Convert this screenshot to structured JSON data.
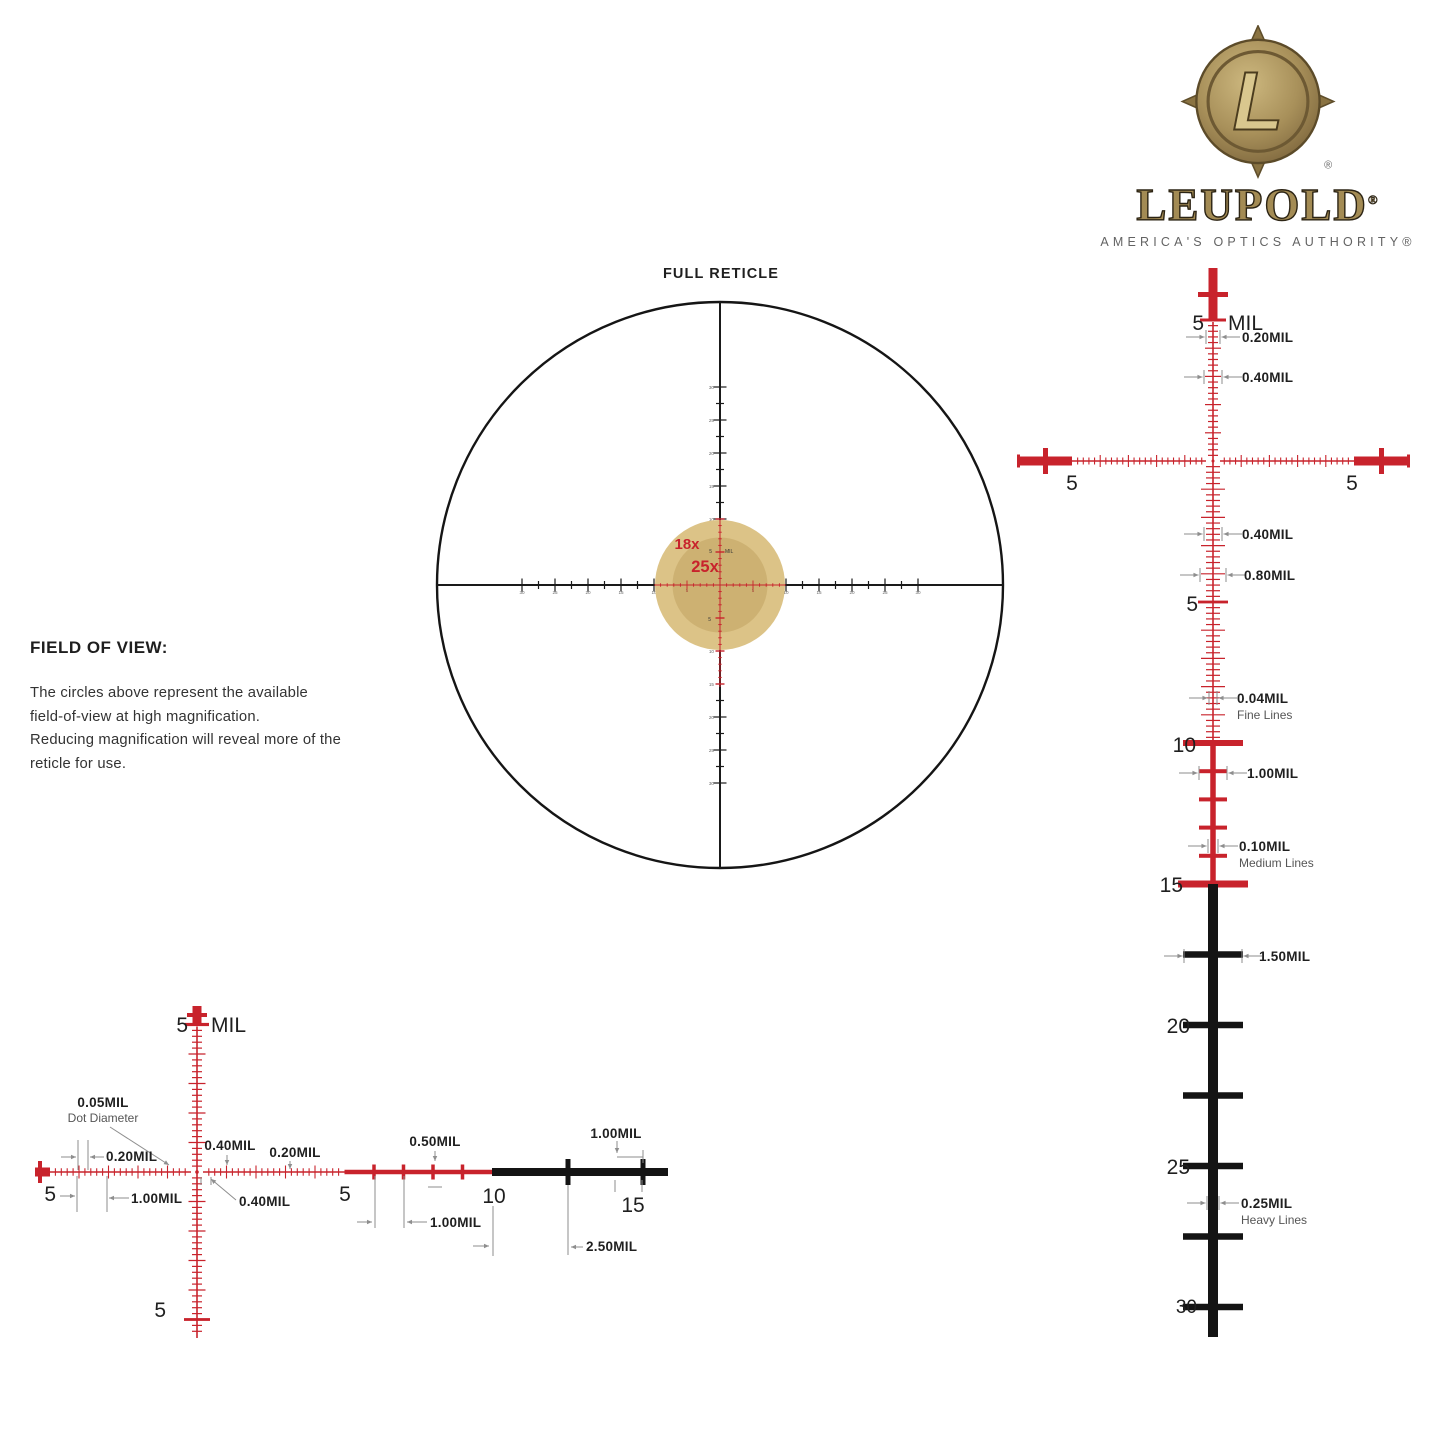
{
  "colors": {
    "red": "#c8232c",
    "black": "#141414",
    "gray": "#8e8e8e",
    "text": "#1f1f1f",
    "sub": "#555555",
    "fov_outer": "#dcc387",
    "fov_inner": "#cdb172"
  },
  "logo": {
    "monogram": "L",
    "registered": "®",
    "wordmark": "LEUPOLD",
    "tagline": "AMERICA'S OPTICS AUTHORITY®"
  },
  "fov": {
    "heading": "FIELD OF VIEW:",
    "lines": [
      "The circles above represent the available",
      "field-of-view at high magnification.",
      "Reducing magnification will reveal more of the",
      "reticle for use."
    ]
  },
  "full_reticle": {
    "title": "FULL RETICLE",
    "axis_labels": [
      "10",
      "15",
      "20",
      "25",
      "30"
    ],
    "labels": [
      {
        "t": "FULL RETICLE",
        "x": 721,
        "y": 278,
        "s": 14.5,
        "cls": "title",
        "n": "full-reticle-title"
      },
      {
        "t": "18x",
        "x": 687,
        "y": 549,
        "s": 15,
        "c": "#c8232c",
        "cls": "mag",
        "n": "magnification-18x-label"
      },
      {
        "t": "25x",
        "x": 705,
        "y": 572,
        "s": 16.5,
        "c": "#c8232c",
        "cls": "mag",
        "n": "magnification-25x-label"
      },
      {
        "t": "5",
        "x": 712,
        "y": 553,
        "s": 5,
        "a": "end",
        "c": "#333333",
        "n": "mil-number"
      },
      {
        "t": "MIL",
        "x": 725,
        "y": 553,
        "s": 5,
        "a": "start",
        "c": "#333333",
        "n": "mil-unit"
      },
      {
        "t": "5",
        "x": 711,
        "y": 621,
        "s": 5,
        "a": "end",
        "c": "#333333",
        "n": "mil-number"
      }
    ]
  },
  "vertical_detail": {
    "labels": [
      {
        "t": "5",
        "x": 1204,
        "y": 330,
        "s": 21,
        "a": "end",
        "cls": "num",
        "n": "mil-number"
      },
      {
        "t": "MIL",
        "x": 1228,
        "y": 330,
        "s": 21,
        "a": "start",
        "cls": "num",
        "n": "mil-unit"
      },
      {
        "t": "0.20MIL",
        "x": 1242,
        "y": 342,
        "s": 13.5,
        "a": "start",
        "cls": "dim",
        "n": "dim-label"
      },
      {
        "t": "0.40MIL",
        "x": 1242,
        "y": 382,
        "s": 13.5,
        "a": "start",
        "cls": "dim",
        "n": "dim-label"
      },
      {
        "t": "0.40MIL",
        "x": 1242,
        "y": 539,
        "s": 13.5,
        "a": "start",
        "cls": "dim",
        "n": "dim-label"
      },
      {
        "t": "0.80MIL",
        "x": 1244,
        "y": 580,
        "s": 13.5,
        "a": "start",
        "cls": "dim",
        "n": "dim-label"
      },
      {
        "t": "5",
        "x": 1198,
        "y": 611,
        "s": 21,
        "a": "end",
        "cls": "num",
        "n": "mil-number"
      },
      {
        "t": "0.04MIL",
        "x": 1237,
        "y": 703,
        "s": 13.5,
        "a": "start",
        "cls": "dim",
        "n": "dim-label"
      },
      {
        "t": "Fine Lines",
        "x": 1237,
        "y": 719,
        "s": 12,
        "a": "start",
        "cls": "sub",
        "n": "line-weight-label"
      },
      {
        "t": "10",
        "x": 1196,
        "y": 752,
        "s": 21,
        "a": "end",
        "cls": "num",
        "n": "mil-number"
      },
      {
        "t": "1.00MIL",
        "x": 1247,
        "y": 778,
        "s": 13.5,
        "a": "start",
        "cls": "dim",
        "n": "dim-label"
      },
      {
        "t": "0.10MIL",
        "x": 1239,
        "y": 851,
        "s": 13.5,
        "a": "start",
        "cls": "dim",
        "n": "dim-label"
      },
      {
        "t": "Medium Lines",
        "x": 1239,
        "y": 867,
        "s": 12,
        "a": "start",
        "cls": "sub",
        "n": "line-weight-label"
      },
      {
        "t": "15",
        "x": 1183,
        "y": 892,
        "s": 21,
        "a": "end",
        "cls": "num",
        "n": "mil-number"
      },
      {
        "t": "1.50MIL",
        "x": 1259,
        "y": 961,
        "s": 13.5,
        "a": "start",
        "cls": "dim",
        "n": "dim-label"
      },
      {
        "t": "20",
        "x": 1190,
        "y": 1033,
        "s": 21,
        "a": "end",
        "cls": "num",
        "n": "mil-number"
      },
      {
        "t": "25",
        "x": 1190,
        "y": 1174,
        "s": 21,
        "a": "end",
        "cls": "num",
        "n": "mil-number"
      },
      {
        "t": "0.25MIL",
        "x": 1241,
        "y": 1208,
        "s": 13.5,
        "a": "start",
        "cls": "dim",
        "n": "dim-label"
      },
      {
        "t": "Heavy Lines",
        "x": 1241,
        "y": 1224,
        "s": 12,
        "a": "start",
        "cls": "sub",
        "n": "line-weight-label"
      },
      {
        "t": "30",
        "x": 1197,
        "y": 1313,
        "s": 19,
        "a": "end",
        "cls": "num",
        "n": "mil-number"
      },
      {
        "t": "5",
        "x": 1072,
        "y": 490,
        "s": 21,
        "a": "middle",
        "cls": "num",
        "n": "mil-number"
      },
      {
        "t": "5",
        "x": 1352,
        "y": 490,
        "s": 21,
        "a": "middle",
        "cls": "num",
        "n": "mil-number"
      }
    ]
  },
  "horizontal_detail": {
    "labels": [
      {
        "t": "5",
        "x": 188,
        "y": 1032,
        "s": 21,
        "a": "end",
        "cls": "num",
        "n": "mil-number"
      },
      {
        "t": "MIL",
        "x": 211,
        "y": 1032,
        "s": 21,
        "a": "start",
        "cls": "num",
        "n": "mil-unit"
      },
      {
        "t": "0.05MIL",
        "x": 103,
        "y": 1107,
        "s": 13.5,
        "a": "middle",
        "cls": "dim",
        "n": "dim-label"
      },
      {
        "t": "Dot Diameter",
        "x": 103,
        "y": 1122,
        "s": 12,
        "a": "middle",
        "cls": "sub",
        "n": "line-weight-label"
      },
      {
        "t": "0.20MIL",
        "x": 106,
        "y": 1161,
        "s": 13.5,
        "a": "start",
        "cls": "dim",
        "n": "dim-label"
      },
      {
        "t": "5",
        "x": 56,
        "y": 1201,
        "s": 21,
        "a": "end",
        "cls": "num",
        "n": "mil-number"
      },
      {
        "t": "1.00MIL",
        "x": 131,
        "y": 1203,
        "s": 13.5,
        "a": "start",
        "cls": "dim",
        "n": "dim-label"
      },
      {
        "t": "0.40MIL",
        "x": 230,
        "y": 1150,
        "s": 13.5,
        "a": "middle",
        "cls": "dim",
        "n": "dim-label"
      },
      {
        "t": "0.20MIL",
        "x": 295,
        "y": 1157,
        "s": 13.5,
        "a": "middle",
        "cls": "dim",
        "n": "dim-label"
      },
      {
        "t": "0.40MIL",
        "x": 239,
        "y": 1206,
        "s": 13.5,
        "a": "start",
        "cls": "dim",
        "n": "dim-label"
      },
      {
        "t": "5",
        "x": 345,
        "y": 1201,
        "s": 21,
        "a": "middle",
        "cls": "num",
        "n": "mil-number"
      },
      {
        "t": "0.50MIL",
        "x": 435,
        "y": 1146,
        "s": 13.5,
        "a": "middle",
        "cls": "dim",
        "n": "dim-label"
      },
      {
        "t": "1.00MIL",
        "x": 430,
        "y": 1227,
        "s": 13.5,
        "a": "start",
        "cls": "dim",
        "n": "dim-label"
      },
      {
        "t": "10",
        "x": 494,
        "y": 1203,
        "s": 21,
        "a": "middle",
        "cls": "num",
        "n": "mil-number"
      },
      {
        "t": "1.00MIL",
        "x": 616,
        "y": 1138,
        "s": 13.5,
        "a": "middle",
        "cls": "dim",
        "n": "dim-label"
      },
      {
        "t": "15",
        "x": 633,
        "y": 1212,
        "s": 21,
        "a": "middle",
        "cls": "num",
        "n": "mil-number"
      },
      {
        "t": "2.50MIL",
        "x": 586,
        "y": 1251,
        "s": 13.5,
        "a": "start",
        "cls": "dim",
        "n": "dim-label"
      },
      {
        "t": "5",
        "x": 166,
        "y": 1317,
        "s": 21,
        "a": "end",
        "cls": "num",
        "n": "mil-number"
      }
    ]
  }
}
